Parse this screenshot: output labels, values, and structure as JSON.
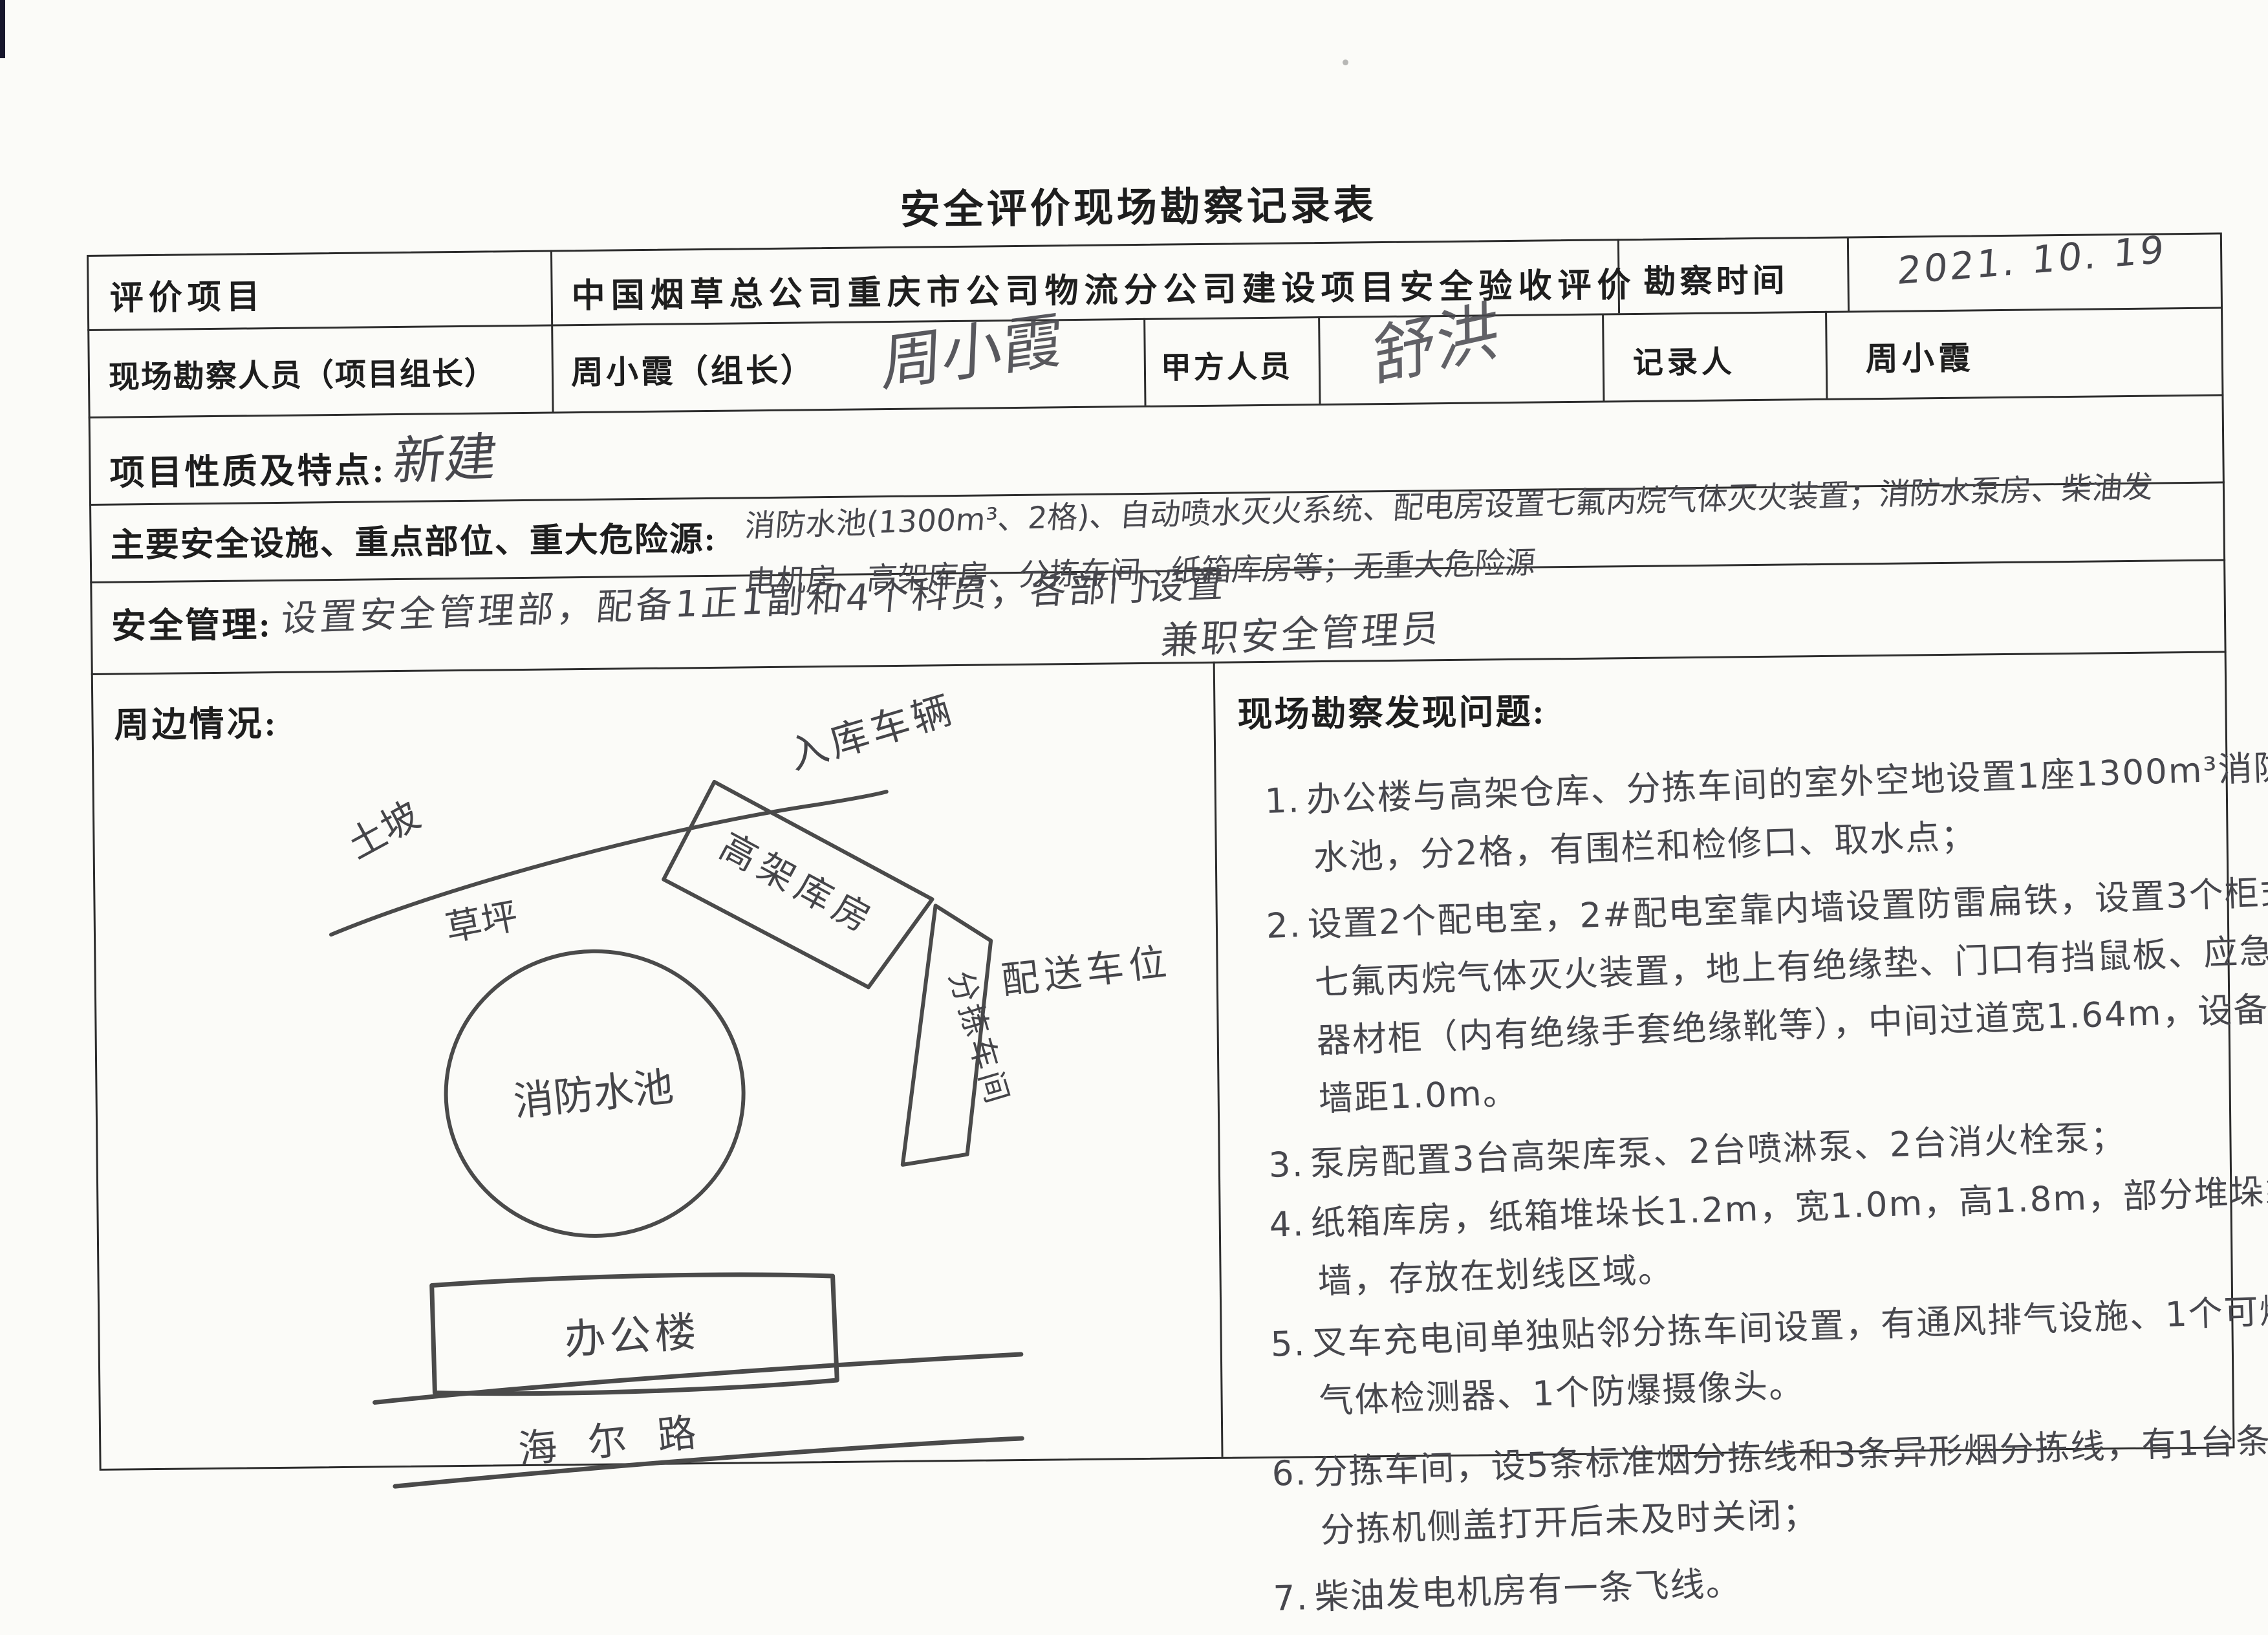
{
  "title": "安全评价现场勘察记录表",
  "table": {
    "row1": {
      "label": "评价项目",
      "value": "中国烟草总公司重庆市公司物流分公司建设项目安全验收评价",
      "time_label": "勘察时间",
      "time_value": "2021. 10. 19"
    },
    "row2": {
      "label": "现场勘察人员（项目组长）",
      "member": "周小霞（组长）",
      "member_signature": "周小霞",
      "party_label": "甲方人员",
      "party_signature": "舒洪",
      "recorder_label": "记录人",
      "recorder": "周小霞"
    },
    "row3": {
      "label": "项目性质及特点:",
      "value": "新建"
    },
    "row4": {
      "label": "主要安全设施、重点部位、重大危险源:",
      "value_line1": "消防水池(1300m³、2格)、自动喷水灭火系统、配电房设置七氟丙烷气体灭火装置；消防水泵房、柴油发",
      "value_line2": "电机房、高架库房、分拣车间、纸箱库房等；无重大危险源"
    },
    "row5": {
      "label": "安全管理:",
      "value_line1": "设置安全管理部，配备1正1副和4个科员，各部门设置",
      "value_line2": "兼职安全管理员"
    },
    "surroundings": {
      "label": "周边情况:"
    },
    "problems": {
      "label": "现场勘察发现问题:",
      "items": [
        {
          "num": "1.",
          "text": "办公楼与高架仓库、分拣车间的室外空地设置1座1300m³消防水池，分2格，有围栏和检修口、取水点；"
        },
        {
          "num": "2.",
          "text": "设置2个配电室，2#配电室靠内墙设置防雷扁铁，设置3个柜式七氟丙烷气体灭火装置，地上有绝缘垫、门口有挡鼠板、应急器材柜（内有绝缘手套绝缘靴等），中间过道宽1.64m，设备与墙距1.0m。"
        },
        {
          "num": "3.",
          "text": "泵房配置3台高架库泵、2台喷淋泵、2台消火栓泵；"
        },
        {
          "num": "4.",
          "text": "纸箱库房，纸箱堆垛长1.2m，宽1.0m，高1.8m，部分堆垛靠墙，存放在划线区域。"
        },
        {
          "num": "5.",
          "text": "叉车充电间单独贴邻分拣车间设置，有通风排气设施、1个可燃气体检测器、1个防爆摄像头。"
        },
        {
          "num": "6.",
          "text": "分拣车间，设5条标准烟分拣线和3条异形烟分拣线，有1台条烟分拣机侧盖打开后未及时关闭；"
        },
        {
          "num": "7.",
          "text": "柴油发电机房有一条飞线。"
        }
      ]
    }
  },
  "sketch": {
    "slope": "土坡",
    "lawn": "草坪",
    "inbound_vehicles": "入库车辆",
    "rack_warehouse": "高架库房",
    "sorting_workshop": "分拣车间",
    "delivery_parking": "配送车位",
    "fire_pool": "消防水池",
    "office_building": "办公楼",
    "road": "海尔路"
  }
}
